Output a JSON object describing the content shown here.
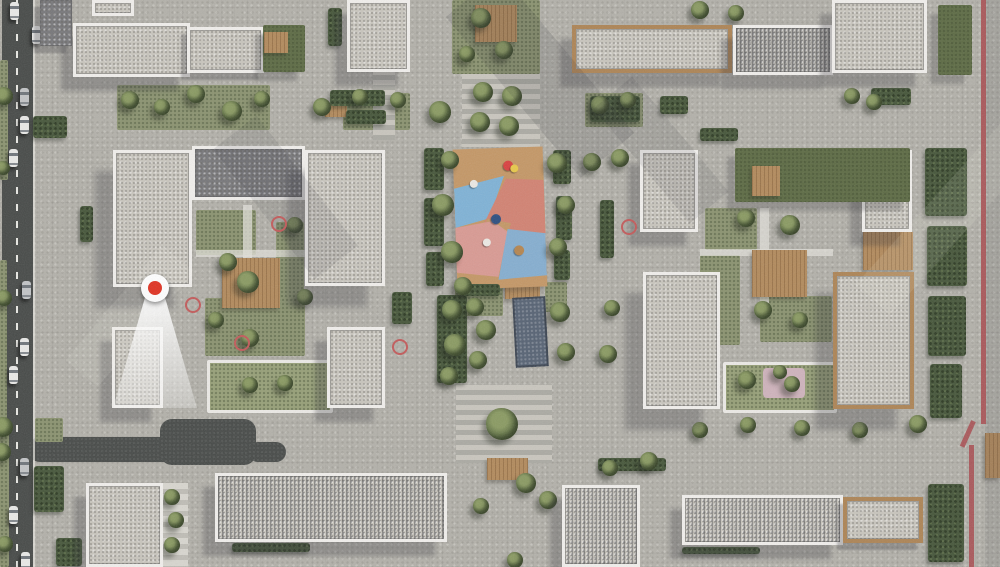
{
  "scene_label": "aerial-architectural-masterplan-render",
  "palette": {
    "pavement": "#b3b1aa",
    "roof_light": "#c8c5bd",
    "roof_mid": "#aeaca7",
    "roof_dark": "#77777a",
    "parapet_white": "#f1efec",
    "wood_trim": "#ad8455",
    "lawn": "#8b9370",
    "hedge": "#46563a",
    "asphalt": "#474a48",
    "lane_line": "#e9e9e4",
    "water": "#566273",
    "boundary_red": "#a84f52",
    "marker_red": "#e03222",
    "cone_white": "#ffffff",
    "playground_tan": "#c49766",
    "playground_blue": "#7fb2d6",
    "playground_coral": "#d28272",
    "playground_pink": "#d99a93",
    "playground_blue2": "#85aed0",
    "play_pink_court": "#cfb3bc",
    "car_white": "#e9e9e7",
    "car_silver": "#c2c4c6"
  },
  "road": {
    "x": 2,
    "width": 31,
    "lane_x": 16,
    "cars": [
      {
        "x": 10,
        "y": 2,
        "c": "white"
      },
      {
        "x": 32,
        "y": 26,
        "c": "white"
      },
      {
        "x": 20,
        "y": 88,
        "c": "silver"
      },
      {
        "x": 20,
        "y": 116,
        "c": "white"
      },
      {
        "x": 9,
        "y": 149,
        "c": "white"
      },
      {
        "x": 22,
        "y": 281,
        "c": "silver"
      },
      {
        "x": 20,
        "y": 338,
        "c": "white"
      },
      {
        "x": 9,
        "y": 366,
        "c": "white"
      },
      {
        "x": 20,
        "y": 458,
        "c": "silver"
      },
      {
        "x": 9,
        "y": 506,
        "c": "white"
      },
      {
        "x": 21,
        "y": 552,
        "c": "white"
      }
    ]
  },
  "access_roads": [
    {
      "x": 28,
      "y": 437,
      "w": 162,
      "h": 25
    },
    {
      "x": 160,
      "y": 419,
      "w": 96,
      "h": 46
    },
    {
      "x": 248,
      "y": 442,
      "w": 38,
      "h": 20
    }
  ],
  "buildings": [
    {
      "x": 73,
      "y": 23,
      "w": 117,
      "h": 54,
      "roof": "L",
      "trim": "W",
      "sh": 2
    },
    {
      "x": 187,
      "y": 27,
      "w": 77,
      "h": 46,
      "roof": "L",
      "trim": "W",
      "sh": 1
    },
    {
      "x": 347,
      "y": 0,
      "w": 63,
      "h": 72,
      "roof": "L",
      "trim": "W",
      "sh": 2
    },
    {
      "x": 572,
      "y": 25,
      "w": 160,
      "h": 48,
      "roof": "L",
      "trim": "Wd",
      "sh": 2
    },
    {
      "x": 733,
      "y": 25,
      "w": 100,
      "h": 50,
      "roof": "M",
      "trim": "W",
      "sh": 2,
      "shade": "left"
    },
    {
      "x": 832,
      "y": 0,
      "w": 95,
      "h": 73,
      "roof": "L",
      "trim": "W",
      "sh": 2
    },
    {
      "x": 40,
      "y": 0,
      "w": 32,
      "h": 46,
      "roof": "D",
      "trim": "N",
      "sh": 1
    },
    {
      "x": 92,
      "y": 0,
      "w": 42,
      "h": 16,
      "roof": "L",
      "trim": "W",
      "sh": 0
    },
    {
      "x": 113,
      "y": 150,
      "w": 79,
      "h": 137,
      "roof": "L",
      "trim": "W",
      "sh": 3
    },
    {
      "x": 192,
      "y": 146,
      "w": 113,
      "h": 54,
      "roof": "D",
      "trim": "W",
      "sh": 0
    },
    {
      "x": 305,
      "y": 150,
      "w": 80,
      "h": 136,
      "roof": "L",
      "trim": "W",
      "sh": 3
    },
    {
      "x": 112,
      "y": 327,
      "w": 51,
      "h": 81,
      "roof": "L",
      "trim": "W",
      "sh": 2
    },
    {
      "x": 327,
      "y": 327,
      "w": 58,
      "h": 81,
      "roof": "L",
      "trim": "W",
      "sh": 2
    },
    {
      "x": 640,
      "y": 150,
      "w": 58,
      "h": 82,
      "roof": "L",
      "trim": "W",
      "sh": 2
    },
    {
      "x": 862,
      "y": 150,
      "w": 50,
      "h": 82,
      "roof": "L",
      "trim": "W",
      "sh": 2
    },
    {
      "x": 643,
      "y": 272,
      "w": 77,
      "h": 137,
      "roof": "L",
      "trim": "W",
      "sh": 3
    },
    {
      "x": 833,
      "y": 272,
      "w": 81,
      "h": 137,
      "roof": "L",
      "trim": "Wd",
      "sh": 3
    },
    {
      "x": 86,
      "y": 483,
      "w": 77,
      "h": 84,
      "roof": "L",
      "trim": "W",
      "sh": 2
    },
    {
      "x": 215,
      "y": 473,
      "w": 232,
      "h": 69,
      "roof": "L",
      "trim": "W",
      "sh": 2,
      "shade": "left"
    },
    {
      "x": 562,
      "y": 485,
      "w": 78,
      "h": 82,
      "roof": "L",
      "trim": "W",
      "sh": 2,
      "shade": "right"
    },
    {
      "x": 682,
      "y": 495,
      "w": 161,
      "h": 50,
      "roof": "L",
      "trim": "W",
      "sh": 2,
      "shade": "right"
    },
    {
      "x": 843,
      "y": 497,
      "w": 80,
      "h": 46,
      "roof": "L",
      "trim": "Wd",
      "sh": 1
    }
  ],
  "roof_gardens": [
    {
      "x": 263,
      "y": 25,
      "w": 42,
      "h": 47,
      "deck": {
        "x": 264,
        "y": 32,
        "w": 24,
        "h": 21
      }
    },
    {
      "x": 735,
      "y": 148,
      "w": 175,
      "h": 54,
      "deck": {
        "x": 752,
        "y": 166,
        "w": 28,
        "h": 30
      }
    },
    {
      "x": 938,
      "y": 5,
      "w": 34,
      "h": 70,
      "deck": null
    }
  ],
  "lawns": [
    {
      "x": 452,
      "y": 0,
      "w": 88,
      "h": 74
    },
    {
      "x": 117,
      "y": 85,
      "w": 153,
      "h": 45
    },
    {
      "x": 343,
      "y": 93,
      "w": 67,
      "h": 37
    },
    {
      "x": 585,
      "y": 93,
      "w": 58,
      "h": 34
    },
    {
      "x": 196,
      "y": 210,
      "w": 60,
      "h": 45
    },
    {
      "x": 276,
      "y": 222,
      "w": 28,
      "h": 85
    },
    {
      "x": 205,
      "y": 298,
      "w": 100,
      "h": 58
    },
    {
      "x": 207,
      "y": 360,
      "w": 120,
      "h": 47,
      "frame": true
    },
    {
      "x": 705,
      "y": 208,
      "w": 52,
      "h": 42
    },
    {
      "x": 700,
      "y": 255,
      "w": 40,
      "h": 90
    },
    {
      "x": 760,
      "y": 296,
      "w": 72,
      "h": 46
    },
    {
      "x": 723,
      "y": 362,
      "w": 108,
      "h": 45,
      "frame": true
    },
    {
      "x": 35,
      "y": 418,
      "w": 28,
      "h": 24
    },
    {
      "x": 0,
      "y": 60,
      "w": 8,
      "h": 120
    },
    {
      "x": 0,
      "y": 260,
      "w": 7,
      "h": 160
    },
    {
      "x": 0,
      "y": 420,
      "w": 9,
      "h": 147
    },
    {
      "x": 455,
      "y": 280,
      "w": 48,
      "h": 36
    },
    {
      "x": 545,
      "y": 282,
      "w": 22,
      "h": 30
    }
  ],
  "patches": [
    {
      "x": 763,
      "y": 368,
      "w": 42,
      "h": 30,
      "color": "#cfb3bc"
    }
  ],
  "stripe_areas": [
    {
      "x": 462,
      "y": 74,
      "w": 78,
      "h": 73,
      "light": false
    },
    {
      "x": 456,
      "y": 385,
      "w": 96,
      "h": 78,
      "light": false
    },
    {
      "x": 373,
      "y": 0,
      "w": 22,
      "h": 140,
      "light": false
    },
    {
      "x": 163,
      "y": 483,
      "w": 25,
      "h": 84,
      "light": true
    }
  ],
  "decks": [
    {
      "x": 475,
      "y": 5,
      "w": 42,
      "h": 37
    },
    {
      "x": 222,
      "y": 258,
      "w": 58,
      "h": 50
    },
    {
      "x": 752,
      "y": 250,
      "w": 55,
      "h": 47
    },
    {
      "x": 863,
      "y": 232,
      "w": 50,
      "h": 38
    },
    {
      "x": 505,
      "y": 278,
      "w": 35,
      "h": 21
    },
    {
      "x": 487,
      "y": 458,
      "w": 41,
      "h": 22
    },
    {
      "x": 325,
      "y": 105,
      "w": 22,
      "h": 12
    },
    {
      "x": 985,
      "y": 433,
      "w": 15,
      "h": 45
    }
  ],
  "paths": [
    {
      "x": 196,
      "y": 250,
      "w": 110,
      "h": 7
    },
    {
      "x": 243,
      "y": 205,
      "w": 9,
      "h": 100
    },
    {
      "x": 700,
      "y": 249,
      "w": 133,
      "h": 7
    },
    {
      "x": 760,
      "y": 208,
      "w": 9,
      "h": 95
    },
    {
      "x": 33,
      "y": 0,
      "w": 2,
      "h": 567
    }
  ],
  "hedges": [
    {
      "x": 424,
      "y": 148,
      "w": 20,
      "h": 42
    },
    {
      "x": 424,
      "y": 198,
      "w": 20,
      "h": 48
    },
    {
      "x": 426,
      "y": 252,
      "w": 18,
      "h": 34
    },
    {
      "x": 437,
      "y": 295,
      "w": 30,
      "h": 88
    },
    {
      "x": 553,
      "y": 150,
      "w": 18,
      "h": 34
    },
    {
      "x": 556,
      "y": 196,
      "w": 16,
      "h": 44
    },
    {
      "x": 554,
      "y": 250,
      "w": 16,
      "h": 30
    },
    {
      "x": 330,
      "y": 90,
      "w": 55,
      "h": 16
    },
    {
      "x": 346,
      "y": 110,
      "w": 40,
      "h": 14
    },
    {
      "x": 590,
      "y": 96,
      "w": 50,
      "h": 26
    },
    {
      "x": 660,
      "y": 96,
      "w": 28,
      "h": 18
    },
    {
      "x": 700,
      "y": 128,
      "w": 38,
      "h": 13
    },
    {
      "x": 871,
      "y": 88,
      "w": 40,
      "h": 17
    },
    {
      "x": 925,
      "y": 148,
      "w": 42,
      "h": 68
    },
    {
      "x": 927,
      "y": 226,
      "w": 40,
      "h": 60
    },
    {
      "x": 928,
      "y": 296,
      "w": 38,
      "h": 60
    },
    {
      "x": 930,
      "y": 364,
      "w": 32,
      "h": 54
    },
    {
      "x": 928,
      "y": 484,
      "w": 36,
      "h": 78
    },
    {
      "x": 598,
      "y": 458,
      "w": 68,
      "h": 13
    },
    {
      "x": 232,
      "y": 543,
      "w": 78,
      "h": 9
    },
    {
      "x": 682,
      "y": 547,
      "w": 78,
      "h": 7
    },
    {
      "x": 33,
      "y": 116,
      "w": 34,
      "h": 22
    },
    {
      "x": 34,
      "y": 466,
      "w": 30,
      "h": 46
    },
    {
      "x": 56,
      "y": 538,
      "w": 26,
      "h": 28
    },
    {
      "x": 80,
      "y": 206,
      "w": 13,
      "h": 36
    },
    {
      "x": 392,
      "y": 292,
      "w": 20,
      "h": 32
    },
    {
      "x": 600,
      "y": 200,
      "w": 14,
      "h": 58
    },
    {
      "x": 460,
      "y": 284,
      "w": 40,
      "h": 12
    },
    {
      "x": 328,
      "y": 8,
      "w": 14,
      "h": 38
    }
  ],
  "trees": [
    {
      "x": 4,
      "y": 96,
      "r": 9
    },
    {
      "x": 3,
      "y": 168,
      "r": 7
    },
    {
      "x": 4,
      "y": 298,
      "r": 8
    },
    {
      "x": 3,
      "y": 427,
      "r": 10
    },
    {
      "x": 2,
      "y": 452,
      "r": 9
    },
    {
      "x": 5,
      "y": 544,
      "r": 8
    },
    {
      "x": 130,
      "y": 100,
      "r": 9
    },
    {
      "x": 162,
      "y": 107,
      "r": 8
    },
    {
      "x": 196,
      "y": 94,
      "r": 9
    },
    {
      "x": 232,
      "y": 111,
      "r": 10
    },
    {
      "x": 262,
      "y": 99,
      "r": 8
    },
    {
      "x": 322,
      "y": 107,
      "r": 9
    },
    {
      "x": 360,
      "y": 97,
      "r": 8
    },
    {
      "x": 398,
      "y": 100,
      "r": 8
    },
    {
      "x": 600,
      "y": 105,
      "r": 9
    },
    {
      "x": 628,
      "y": 100,
      "r": 8
    },
    {
      "x": 481,
      "y": 18,
      "r": 10
    },
    {
      "x": 504,
      "y": 50,
      "r": 9
    },
    {
      "x": 467,
      "y": 54,
      "r": 8
    },
    {
      "x": 700,
      "y": 10,
      "r": 9
    },
    {
      "x": 736,
      "y": 13,
      "r": 8
    },
    {
      "x": 483,
      "y": 92,
      "r": 10
    },
    {
      "x": 512,
      "y": 96,
      "r": 10
    },
    {
      "x": 480,
      "y": 122,
      "r": 10
    },
    {
      "x": 509,
      "y": 126,
      "r": 10
    },
    {
      "x": 440,
      "y": 112,
      "r": 11
    },
    {
      "x": 450,
      "y": 160,
      "r": 9
    },
    {
      "x": 443,
      "y": 205,
      "r": 11
    },
    {
      "x": 452,
      "y": 252,
      "r": 11
    },
    {
      "x": 463,
      "y": 286,
      "r": 9
    },
    {
      "x": 557,
      "y": 163,
      "r": 10
    },
    {
      "x": 566,
      "y": 205,
      "r": 9
    },
    {
      "x": 558,
      "y": 247,
      "r": 9
    },
    {
      "x": 592,
      "y": 162,
      "r": 9
    },
    {
      "x": 620,
      "y": 158,
      "r": 9
    },
    {
      "x": 452,
      "y": 310,
      "r": 10
    },
    {
      "x": 455,
      "y": 345,
      "r": 11
    },
    {
      "x": 449,
      "y": 376,
      "r": 9
    },
    {
      "x": 475,
      "y": 307,
      "r": 9
    },
    {
      "x": 486,
      "y": 330,
      "r": 10
    },
    {
      "x": 478,
      "y": 360,
      "r": 9
    },
    {
      "x": 560,
      "y": 312,
      "r": 10
    },
    {
      "x": 566,
      "y": 352,
      "r": 9
    },
    {
      "x": 608,
      "y": 354,
      "r": 9
    },
    {
      "x": 612,
      "y": 308,
      "r": 8
    },
    {
      "x": 502,
      "y": 424,
      "r": 16
    },
    {
      "x": 526,
      "y": 483,
      "r": 10
    },
    {
      "x": 548,
      "y": 500,
      "r": 9
    },
    {
      "x": 481,
      "y": 506,
      "r": 8
    },
    {
      "x": 515,
      "y": 560,
      "r": 8
    },
    {
      "x": 746,
      "y": 218,
      "r": 9
    },
    {
      "x": 790,
      "y": 225,
      "r": 10
    },
    {
      "x": 763,
      "y": 310,
      "r": 9
    },
    {
      "x": 800,
      "y": 320,
      "r": 8
    },
    {
      "x": 747,
      "y": 380,
      "r": 9
    },
    {
      "x": 792,
      "y": 384,
      "r": 8
    },
    {
      "x": 780,
      "y": 372,
      "r": 7
    },
    {
      "x": 757,
      "y": 160,
      "r": 7,
      "z": 6
    },
    {
      "x": 788,
      "y": 172,
      "r": 8,
      "z": 6
    },
    {
      "x": 824,
      "y": 163,
      "r": 7,
      "z": 6
    },
    {
      "x": 862,
      "y": 174,
      "r": 7,
      "z": 6
    },
    {
      "x": 900,
      "y": 160,
      "r": 7,
      "z": 6
    },
    {
      "x": 292,
      "y": 60,
      "r": 7,
      "z": 6
    },
    {
      "x": 248,
      "y": 282,
      "r": 11
    },
    {
      "x": 228,
      "y": 262,
      "r": 9
    },
    {
      "x": 305,
      "y": 297,
      "r": 8
    },
    {
      "x": 250,
      "y": 338,
      "r": 9
    },
    {
      "x": 216,
      "y": 320,
      "r": 8
    },
    {
      "x": 295,
      "y": 225,
      "r": 8
    },
    {
      "x": 250,
      "y": 385,
      "r": 8
    },
    {
      "x": 285,
      "y": 383,
      "r": 8
    },
    {
      "x": 172,
      "y": 497,
      "r": 8
    },
    {
      "x": 176,
      "y": 520,
      "r": 8
    },
    {
      "x": 172,
      "y": 545,
      "r": 8
    },
    {
      "x": 610,
      "y": 468,
      "r": 8
    },
    {
      "x": 649,
      "y": 461,
      "r": 9
    },
    {
      "x": 700,
      "y": 430,
      "r": 8
    },
    {
      "x": 748,
      "y": 425,
      "r": 8
    },
    {
      "x": 802,
      "y": 428,
      "r": 8
    },
    {
      "x": 860,
      "y": 430,
      "r": 8
    },
    {
      "x": 918,
      "y": 424,
      "r": 9
    },
    {
      "x": 852,
      "y": 96,
      "r": 8
    },
    {
      "x": 874,
      "y": 102,
      "r": 8
    }
  ],
  "water_feature": {
    "x": 514,
    "y": 297,
    "w": 33,
    "h": 70,
    "rot": -3
  },
  "playground": {
    "x": 455,
    "y": 148,
    "w": 90,
    "h": 140,
    "rot": -2,
    "base": "#c49766",
    "patches": [
      {
        "c": "#7fb2d6",
        "poly": "0% 28%,56% 20%,38% 50%,0% 56%"
      },
      {
        "c": "#d28272",
        "poly": "58% 22%,100% 24%,100% 62%,30% 56%"
      },
      {
        "c": "#c49766",
        "poly": "36% 50%,62% 54%,50% 78%,20% 70%"
      },
      {
        "c": "#d99a93",
        "poly": "0% 56%,42% 52%,58% 60%,46% 92%,0% 88%"
      },
      {
        "c": "#85aed0",
        "poly": "58% 58%,100% 62%,100% 92%,46% 94%"
      }
    ],
    "dots": [
      {
        "x": 55,
        "y": 9,
        "c": "#d94040",
        "r": 5
      },
      {
        "x": 63,
        "y": 12,
        "c": "#e8c84a",
        "r": 4
      },
      {
        "x": 18,
        "y": 22,
        "c": "#ece9e4",
        "r": 4
      },
      {
        "x": 40,
        "y": 47,
        "c": "#2e4e80",
        "r": 5
      },
      {
        "x": 30,
        "y": 64,
        "c": "#ece9e4",
        "r": 4
      },
      {
        "x": 64,
        "y": 70,
        "c": "#b5854f",
        "r": 5
      }
    ]
  },
  "red_rings": [
    {
      "x": 277,
      "y": 222
    },
    {
      "x": 191,
      "y": 303
    },
    {
      "x": 240,
      "y": 341
    },
    {
      "x": 398,
      "y": 345
    },
    {
      "x": 627,
      "y": 225
    }
  ],
  "boundary": {
    "segments": [
      {
        "x": 981,
        "y": 0,
        "h": 424,
        "rot": 0
      },
      {
        "x": 971,
        "y": 421,
        "h": 28,
        "rot": 24
      },
      {
        "x": 969,
        "y": 445,
        "h": 122,
        "rot": 0
      }
    ],
    "width": 4.5
  },
  "marker": {
    "x": 155,
    "y": 288
  },
  "shade_bands": [
    {
      "x": 505,
      "y": -30,
      "w": 70,
      "h": 210,
      "rot": -40,
      "a": 0.13
    },
    {
      "x": 258,
      "y": 115,
      "w": 55,
      "h": 165,
      "rot": -38,
      "a": 0.1
    },
    {
      "x": 636,
      "y": 75,
      "w": 50,
      "h": 150,
      "rot": -40,
      "a": 0.1
    },
    {
      "x": 985,
      "y": 0,
      "w": 15,
      "h": 567,
      "rot": 0,
      "a": 0.1
    }
  ],
  "light_bands": [
    {
      "x": 830,
      "y": 180,
      "w": 260,
      "h": 46,
      "rot": -48,
      "a": 0.1
    },
    {
      "x": 55,
      "y": 295,
      "w": 150,
      "h": 42,
      "rot": -50,
      "a": 0.09
    }
  ]
}
